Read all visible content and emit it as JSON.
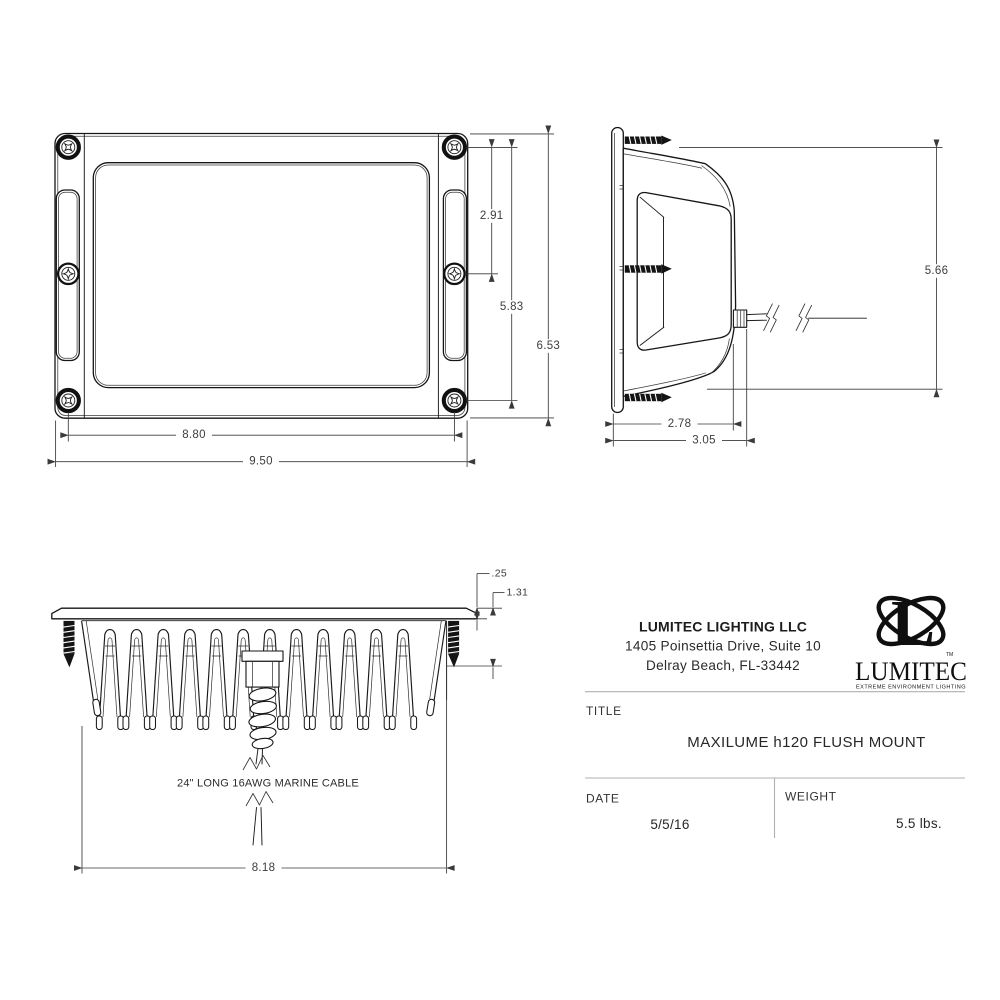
{
  "front_view": {
    "dim_screw_to_screw_upper": "2.91",
    "dim_screw_span_vertical": "5.83",
    "dim_overall_height": "6.53",
    "dim_screw_span_horizontal": "8.80",
    "dim_overall_width": "9.50"
  },
  "side_view": {
    "dim_overall_height": "5.66",
    "dim_body_depth": "2.78",
    "dim_overall_depth": "3.05"
  },
  "rear_view": {
    "dim_flange_thickness": ".25",
    "dim_mount_depth": "1.31",
    "dim_body_width": "8.18",
    "cable_note": "24\" LONG 16AWG MARINE CABLE"
  },
  "title_block": {
    "company": "LUMITEC LIGHTING LLC",
    "address_line1": "1405 Poinsettia Drive, Suite 10",
    "address_line2": "Delray Beach, FL-33442",
    "title_label": "TITLE",
    "title_value": "MAXILUME h120 FLUSH MOUNT",
    "date_label": "DATE",
    "date_value": "5/5/16",
    "weight_label": "WEIGHT",
    "weight_value": "5.5 lbs.",
    "logo": {
      "monogram": "L",
      "wordmark": "LUMITEC",
      "tagline": "EXTREME ENVIRONMENT LIGHTING",
      "trademark": "TM"
    }
  }
}
